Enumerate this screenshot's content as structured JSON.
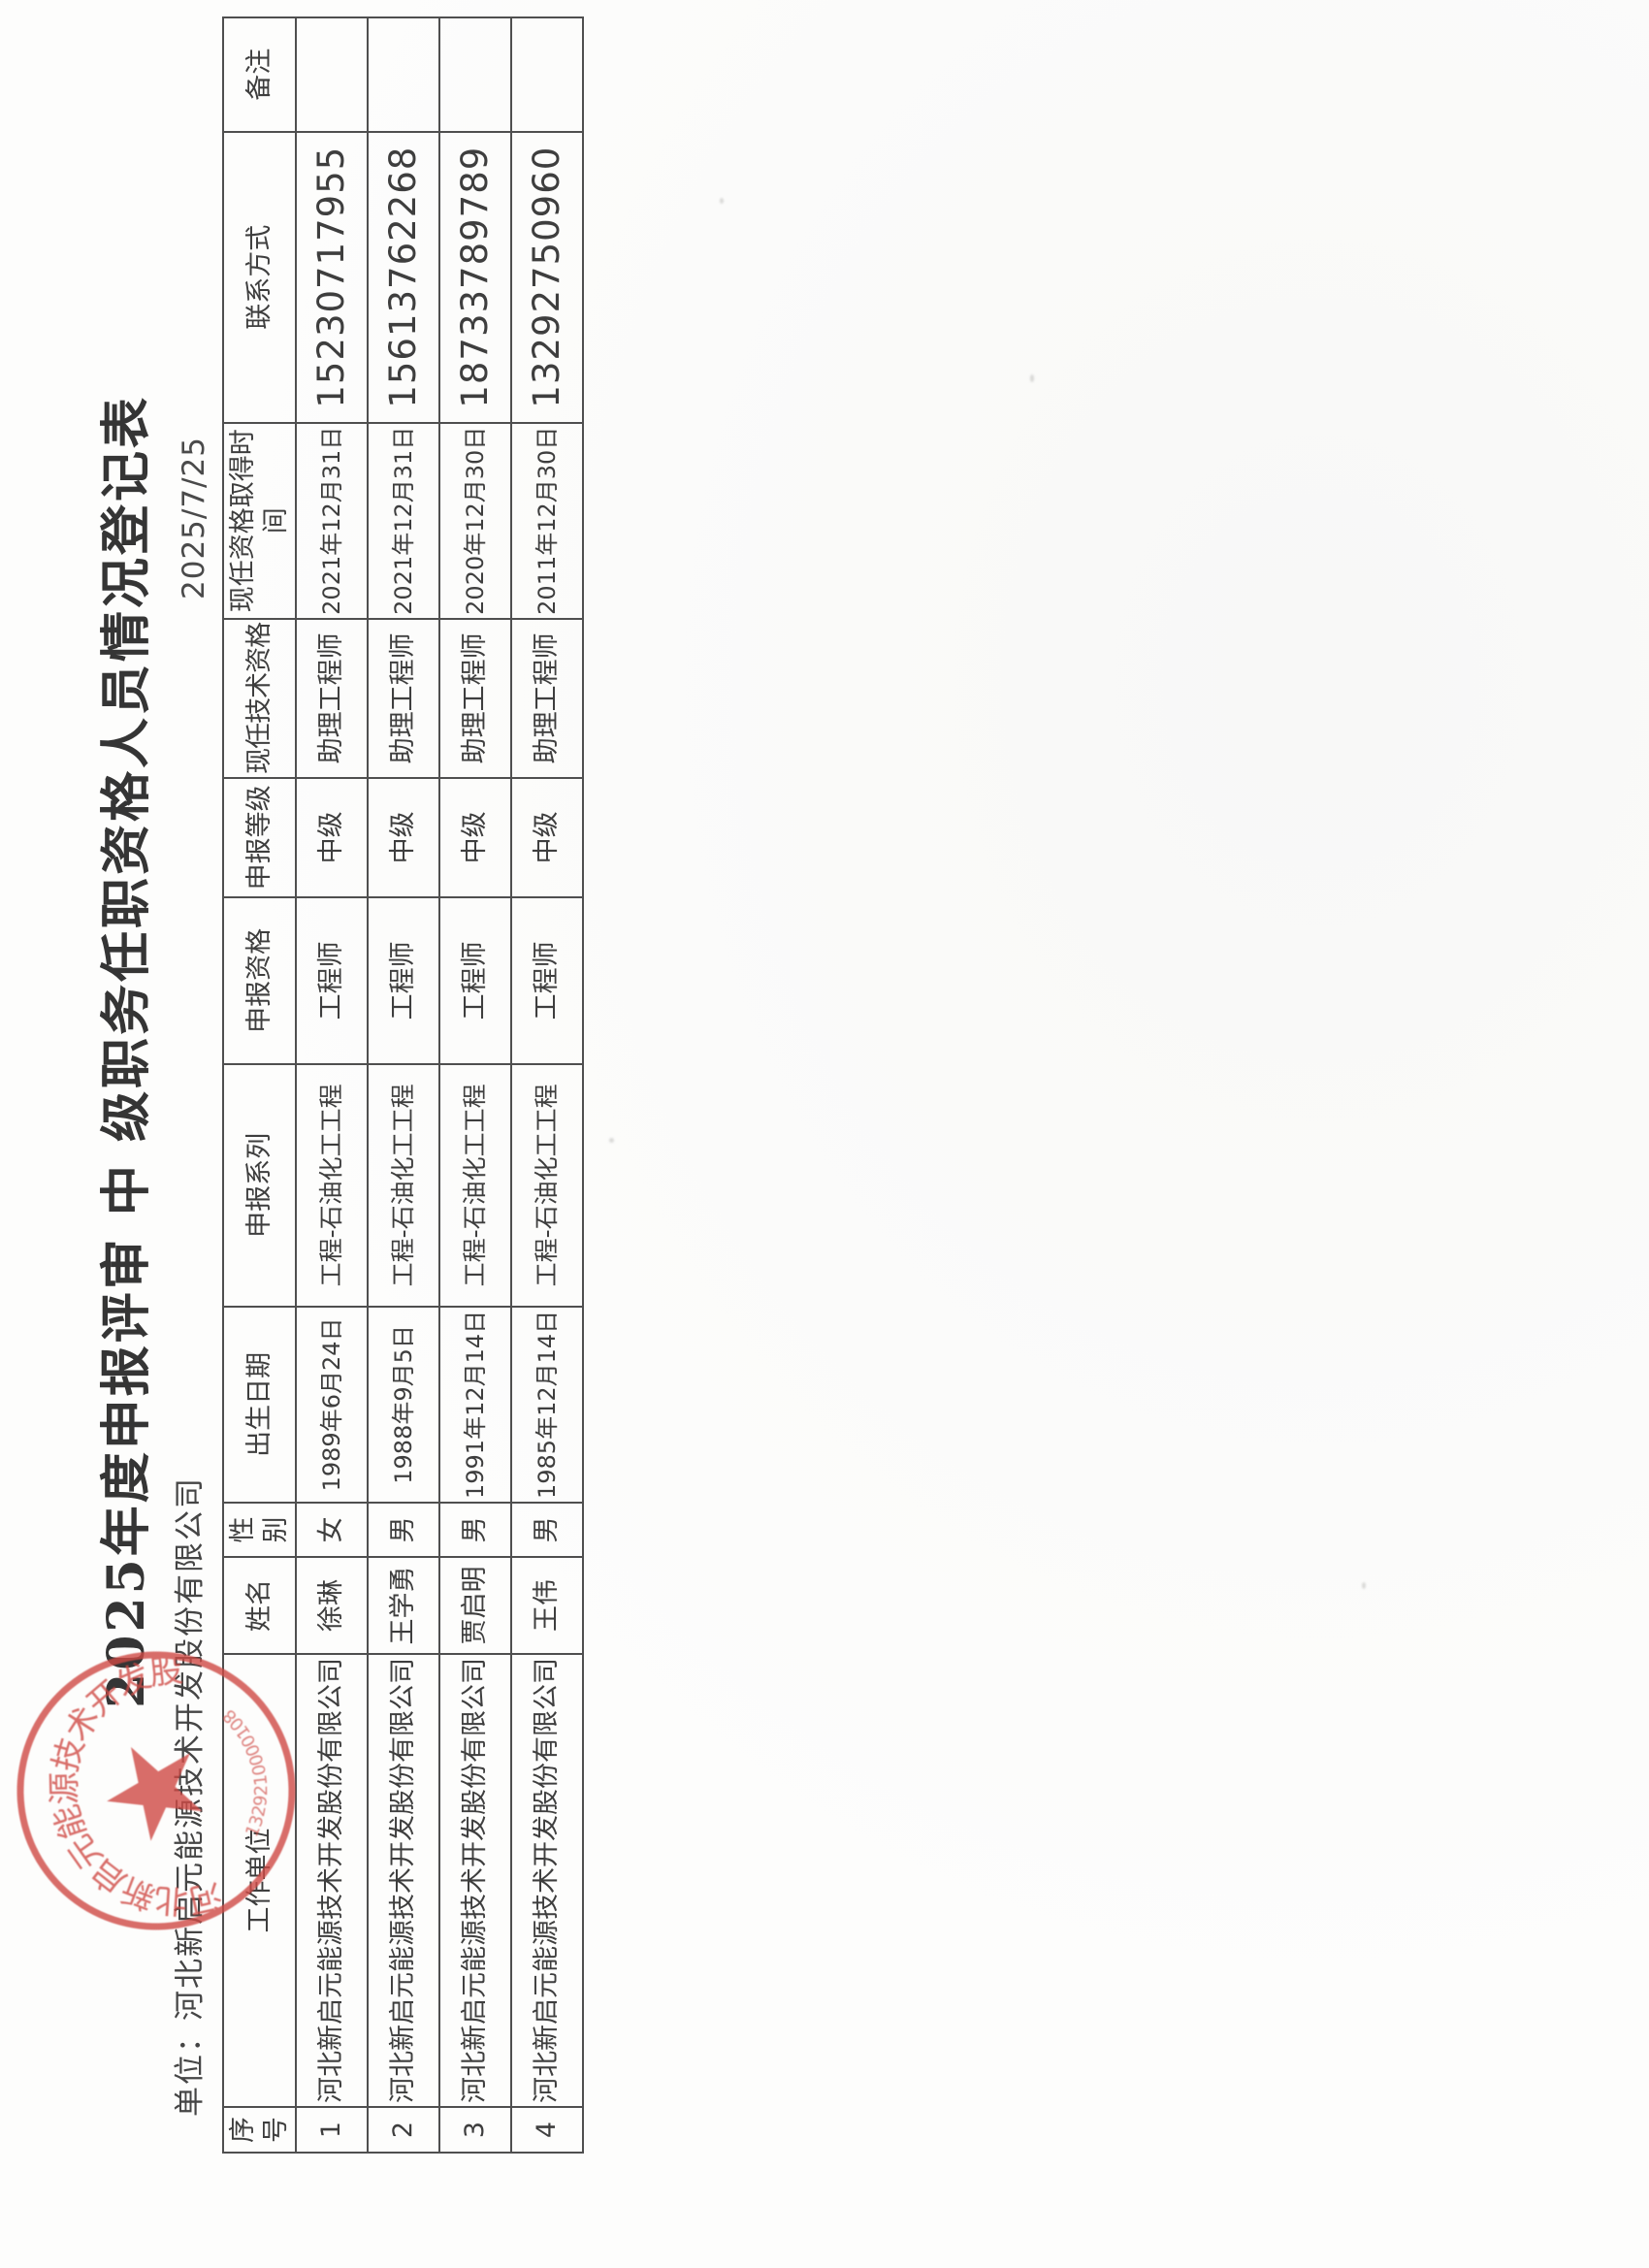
{
  "document": {
    "title": "2025年度申报评审 中 级职务任职资格人员情况登记表",
    "unit_line": "单位：河北新启元能源技术开发股份有限公司",
    "date": "2025/7/25"
  },
  "table": {
    "columns": [
      {
        "key": "index",
        "label": "序号"
      },
      {
        "key": "employer",
        "label": "工作单位"
      },
      {
        "key": "name",
        "label": "姓名"
      },
      {
        "key": "gender",
        "label": "性别"
      },
      {
        "key": "birth",
        "label": "出生日期"
      },
      {
        "key": "series",
        "label": "申报系列"
      },
      {
        "key": "qual",
        "label": "申报资格"
      },
      {
        "key": "level",
        "label": "申报等级"
      },
      {
        "key": "current",
        "label": "现任技术资格"
      },
      {
        "key": "obtained",
        "label": "现任资格取得时间"
      },
      {
        "key": "contact",
        "label": "联系方式"
      },
      {
        "key": "remark",
        "label": "备注"
      }
    ],
    "rows": [
      {
        "index": "1",
        "employer": "河北新启元能源技术开发股份有限公司",
        "name": "徐琳",
        "gender": "女",
        "birth": "1989年6月24日",
        "series": "工程-石油化工工程",
        "qual": "工程师",
        "level": "中级",
        "current": "助理工程师",
        "obtained": "2021年12月31日",
        "contact": "15230717955",
        "remark": ""
      },
      {
        "index": "2",
        "employer": "河北新启元能源技术开发股份有限公司",
        "name": "王学勇",
        "gender": "男",
        "birth": "1988年9月5日",
        "series": "工程-石油化工工程",
        "qual": "工程师",
        "level": "中级",
        "current": "助理工程师",
        "obtained": "2021年12月31日",
        "contact": "15613762268",
        "remark": ""
      },
      {
        "index": "3",
        "employer": "河北新启元能源技术开发股份有限公司",
        "name": "贾启明",
        "gender": "男",
        "birth": "1991年12月14日",
        "series": "工程-石油化工工程",
        "qual": "工程师",
        "level": "中级",
        "current": "助理工程师",
        "obtained": "2020年12月30日",
        "contact": "18733789789",
        "remark": ""
      },
      {
        "index": "4",
        "employer": "河北新启元能源技术开发股份有限公司",
        "name": "王伟",
        "gender": "男",
        "birth": "1985年12月14日",
        "series": "工程-石油化工工程",
        "qual": "工程师",
        "level": "中级",
        "current": "助理工程师",
        "obtained": "2011年12月30日",
        "contact": "13292750960",
        "remark": ""
      }
    ]
  },
  "stamp": {
    "company": "河北新启元能源技术开发股份有限公司",
    "serial": "1329210000108",
    "color": "#cf4a45"
  }
}
